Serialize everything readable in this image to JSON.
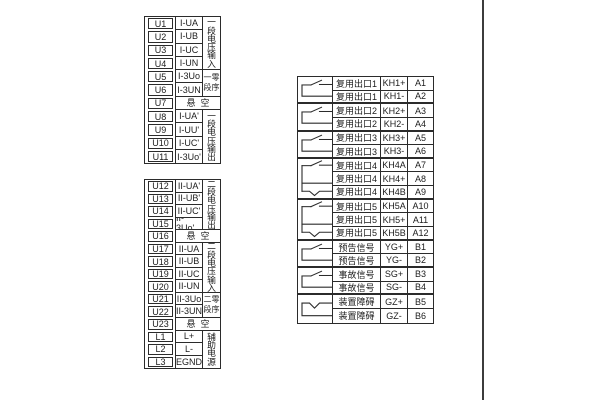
{
  "colors": {
    "line": "#2b2b2b",
    "background": "#ffffff",
    "text": "#1c1c1c"
  },
  "left_table_1": {
    "rows": [
      {
        "id": "U1",
        "signal": "I-UA"
      },
      {
        "id": "U2",
        "signal": "I-UB"
      },
      {
        "id": "U3",
        "signal": "I-UC"
      },
      {
        "id": "U4",
        "signal": "I-UN"
      },
      {
        "id": "U5",
        "signal": "I-3Uo"
      },
      {
        "id": "U6",
        "signal": "I-3UN"
      },
      {
        "id": "U7",
        "signal": "悬空"
      },
      {
        "id": "U8",
        "signal": "I-UA'"
      },
      {
        "id": "U9",
        "signal": "I-UU'"
      },
      {
        "id": "U10",
        "signal": "I-UC'"
      },
      {
        "id": "U11",
        "signal": "I-3Uo'"
      }
    ],
    "groups": [
      {
        "label": "一段电压输入"
      },
      {
        "label": "一零段序"
      },
      {
        "label": "一段电压输出"
      }
    ]
  },
  "left_table_2": {
    "rows": [
      {
        "id": "U12",
        "signal": "II-UA'"
      },
      {
        "id": "U13",
        "signal": "II-UB'"
      },
      {
        "id": "U14",
        "signal": "II-UC'"
      },
      {
        "id": "U15",
        "signal": "II-3Uo'"
      },
      {
        "id": "U16",
        "signal": "悬空"
      },
      {
        "id": "U17",
        "signal": "II-UA"
      },
      {
        "id": "U18",
        "signal": "II-UB"
      },
      {
        "id": "U19",
        "signal": "II-UC"
      },
      {
        "id": "U20",
        "signal": "II-UN"
      },
      {
        "id": "U21",
        "signal": "II-3Uo"
      },
      {
        "id": "U22",
        "signal": "II-3UN"
      },
      {
        "id": "U23",
        "signal": "悬空"
      },
      {
        "id": "L1",
        "signal": "L+"
      },
      {
        "id": "L2",
        "signal": "L-"
      },
      {
        "id": "L3",
        "signal": "EGND"
      }
    ],
    "groups": [
      {
        "label": "二段电压输出"
      },
      {
        "label": "二段电压输入"
      },
      {
        "label": "二零段序"
      },
      {
        "label": "辅助电源"
      }
    ]
  },
  "right_table": {
    "rows": [
      {
        "name": "复用出口1",
        "code": "KH1+",
        "term": "A1"
      },
      {
        "name": "复用出口1",
        "code": "KH1-",
        "term": "A2"
      },
      {
        "name": "复用出口2",
        "code": "KH2+",
        "term": "A3"
      },
      {
        "name": "复用出口2",
        "code": "KH2-",
        "term": "A4"
      },
      {
        "name": "复用出口3",
        "code": "KH3+",
        "term": "A5"
      },
      {
        "name": "复用出口3",
        "code": "KH3-",
        "term": "A6"
      },
      {
        "name": "复用出口4",
        "code": "KH4A",
        "term": "A7"
      },
      {
        "name": "复用出口4",
        "code": "KH4+",
        "term": "A8"
      },
      {
        "name": "复用出口4",
        "code": "KH4B",
        "term": "A9"
      },
      {
        "name": "复用出口5",
        "code": "KH5A",
        "term": "A10"
      },
      {
        "name": "复用出口5",
        "code": "KH5+",
        "term": "A11"
      },
      {
        "name": "复用出口5",
        "code": "KH5B",
        "term": "A12"
      },
      {
        "name": "预告信号",
        "code": "YG+",
        "term": "B1"
      },
      {
        "name": "预告信号",
        "code": "YG-",
        "term": "B2"
      },
      {
        "name": "事故信号",
        "code": "SG+",
        "term": "B3"
      },
      {
        "name": "事故信号",
        "code": "SG-",
        "term": "B4"
      },
      {
        "name": "装置障碍",
        "code": "GZ+",
        "term": "B5"
      },
      {
        "name": "装置障碍",
        "code": "GZ-",
        "term": "B6"
      }
    ],
    "symbols": [
      {
        "icon": "relay-no-contact",
        "rows": "1-2"
      },
      {
        "icon": "relay-no-contact",
        "rows": "3-4"
      },
      {
        "icon": "relay-no-contact",
        "rows": "5-6"
      },
      {
        "icon": "relay-changeover-contact",
        "rows": "7-9"
      },
      {
        "icon": "relay-changeover-contact",
        "rows": "10-12"
      },
      {
        "icon": "relay-no-contact",
        "rows": "13-14"
      },
      {
        "icon": "relay-no-contact",
        "rows": "15-16"
      },
      {
        "icon": "relay-nc-contact",
        "rows": "17-18"
      }
    ]
  }
}
